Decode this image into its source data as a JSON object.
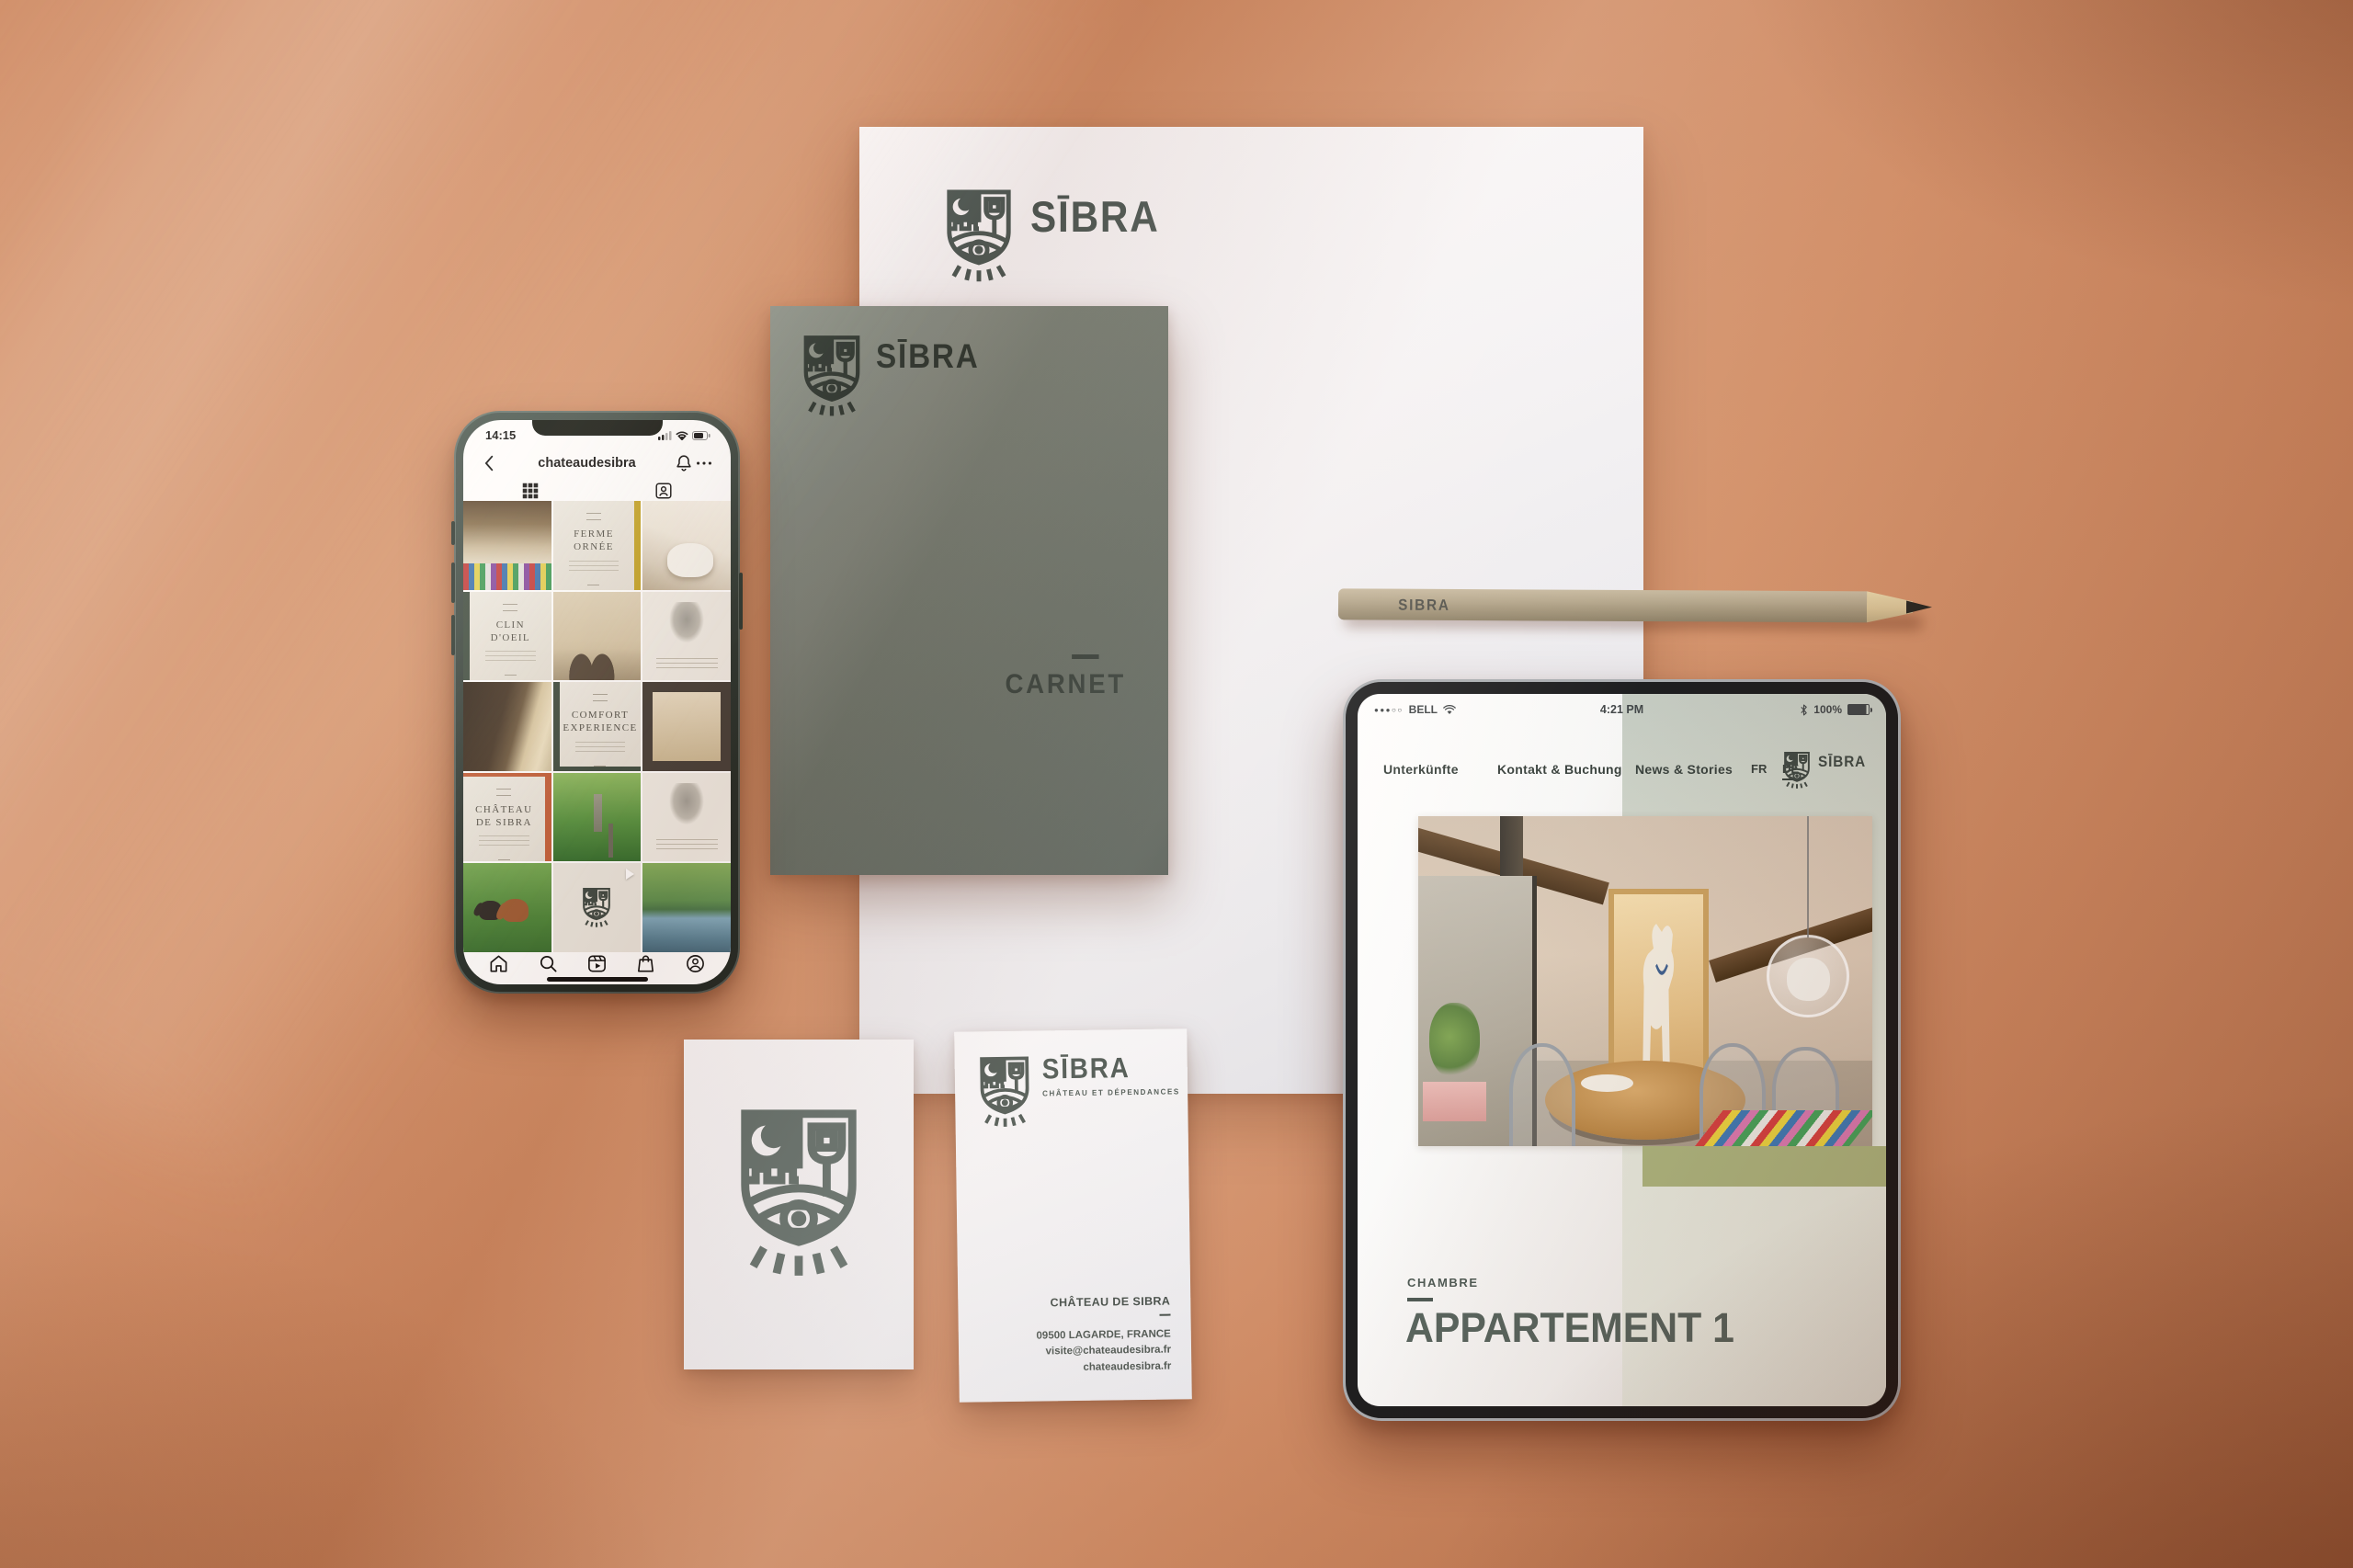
{
  "brand": {
    "name": "SIBRA",
    "wordmark": "SĪBRA",
    "tagline": "CHÂTEAU ET DÉPENDANCES"
  },
  "colors": {
    "background": "#cf8a63",
    "brand_green": "#47544f",
    "notebook_green": "#6a746b",
    "olive_block": "#a9b37d",
    "pale_green_panel": "#dde4da",
    "accent_rust": "#c2603b",
    "accent_mustard": "#c3a428"
  },
  "phone": {
    "status": {
      "time": "14:15"
    },
    "header": {
      "title": "chateaudesibra"
    },
    "tiles": [
      {
        "type": "photo",
        "subject": "interior room with striped rug"
      },
      {
        "type": "text",
        "title": "FERME ORNÉE"
      },
      {
        "type": "photo",
        "subject": "bathroom with tub"
      },
      {
        "type": "text",
        "title": "CLIN D'OEIL"
      },
      {
        "type": "photo",
        "subject": "stone chateau facade"
      },
      {
        "type": "illustration",
        "subject": "rabbit etching"
      },
      {
        "type": "photo",
        "subject": "stone archway terrace"
      },
      {
        "type": "text",
        "title": "COMFORT EXPERIENCE"
      },
      {
        "type": "photo",
        "subject": "doorway to courtyard"
      },
      {
        "type": "text",
        "title": "CHÂTEAU DE SIBRA"
      },
      {
        "type": "photo",
        "subject": "park alley with obelisk"
      },
      {
        "type": "illustration",
        "subject": "figure etching"
      },
      {
        "type": "photo",
        "subject": "horses in meadow"
      },
      {
        "type": "logo",
        "subject": "SIBRA crest video"
      },
      {
        "type": "photo",
        "subject": "pond in garden"
      }
    ],
    "nav": [
      "home",
      "search",
      "reels",
      "shop",
      "profile"
    ]
  },
  "notebook": {
    "label": "CARNET"
  },
  "pencil": {
    "label": "SIBRA"
  },
  "tablet": {
    "status": {
      "signal_dots": "●●●○○",
      "carrier": "BELL",
      "time": "4:21 PM",
      "battery": "100%"
    },
    "nav": [
      "Unterkünfte",
      "Kontakt & Buchung",
      "News & Stories"
    ],
    "languages": [
      "FR",
      "DE"
    ],
    "active_language": "DE",
    "eyebrow": "CHAMBRE",
    "title": "APPARTEMENT 1"
  },
  "business_card": {
    "company": "CHÂTEAU DE SIBRA",
    "address": "09500 LAGARDE, FRANCE",
    "email": "visite@chateaudesibra.fr",
    "website": "chateaudesibra.fr"
  }
}
